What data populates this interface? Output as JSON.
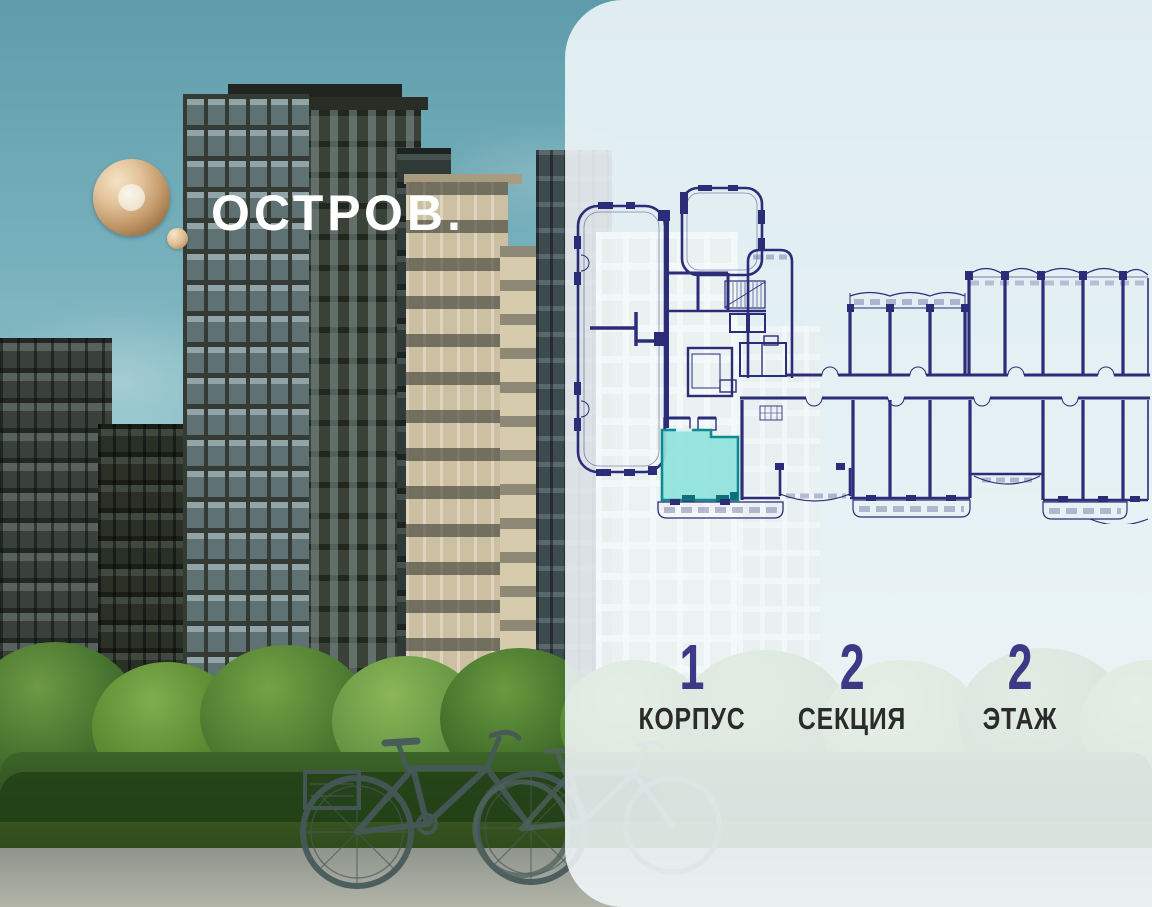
{
  "brand": {
    "logo_text": "ОСТРОВ.",
    "logo_mark": "gold-ring-with-dot"
  },
  "unit_info": {
    "stats": [
      {
        "value": "1",
        "label": "КОРПУС"
      },
      {
        "value": "2",
        "label": "СЕКЦИЯ"
      },
      {
        "value": "2",
        "label": "ЭТАЖ"
      }
    ]
  },
  "floorplan": {
    "type": "architectural-floor-plan",
    "highlighted_unit": {
      "status": "selected",
      "fill": "#8fe3dc",
      "stroke": "#0e8b90"
    },
    "wall_color": "#2b2d78"
  },
  "colors": {
    "accent_teal": "#8fe3dc",
    "plan_navy": "#2b2d78",
    "stat_number": "#3c3a86",
    "stat_label": "#2c2b2b",
    "logo_gold": "#d4b389",
    "panel_bg": "rgba(242,248,250,0.87)",
    "sky": "#74aeba"
  }
}
